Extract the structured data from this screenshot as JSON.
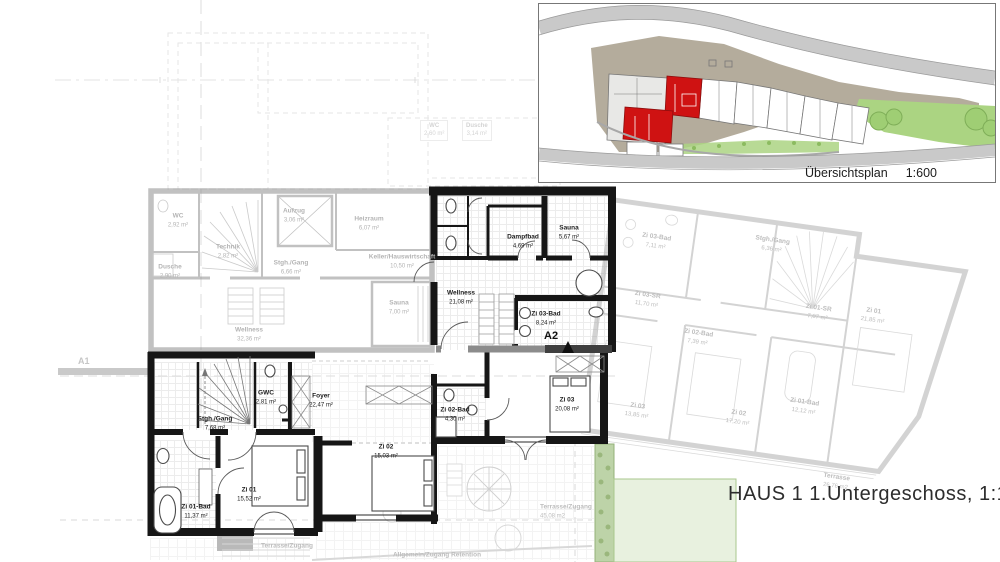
{
  "title": {
    "text": "HAUS 1 1.Untergeschoss, 1:100"
  },
  "overview": {
    "label": "Übersichtsplan",
    "scale": "1:600"
  },
  "section_markers": {
    "a1": "A1",
    "a2": "A2"
  },
  "palette": {
    "highlight_red": "#cf1212",
    "site_taupe": "#b4ac9c",
    "garden_green": "#abd482",
    "pale_green": "#e8f1df",
    "road_gray": "#c9c9c9",
    "wall_black": "#161616"
  },
  "main_plan": {
    "rooms": [
      {
        "name": "Dampfbad",
        "area": "4,69 m²"
      },
      {
        "name": "Sauna",
        "area": "5,67 m²"
      },
      {
        "name": "Wellness",
        "area": "21,08 m²"
      },
      {
        "name": "Zi 03-Bad",
        "area": "8,24 m²"
      },
      {
        "name": "Zi 03",
        "area": "20,08 m²"
      },
      {
        "name": "Foyer",
        "area": "22,47 m²"
      },
      {
        "name": "GWC",
        "area": "2,81 m²"
      },
      {
        "name": "Stgh./Gang",
        "area": "7,68 m²"
      },
      {
        "name": "Zi 02",
        "area": "15,03 m²"
      },
      {
        "name": "Zi 02-Bad",
        "area": "4,30 m²"
      },
      {
        "name": "Zi 01",
        "area": "15,52 m²"
      },
      {
        "name": "Zi 01-Bad",
        "area": "11,37 m²"
      }
    ]
  },
  "left_plan": {
    "rooms": [
      {
        "name": "WC",
        "area": "2,92 m²"
      },
      {
        "name": "Aufzug",
        "area": "3,06 m²"
      },
      {
        "name": "Heizraum",
        "area": "6,07 m²"
      },
      {
        "name": "Technik",
        "area": "2,82 m²"
      },
      {
        "name": "Stgh./Gang",
        "area": "6,66 m²"
      },
      {
        "name": "Keller/Hauswirtschaft",
        "area": "10,50 m²"
      },
      {
        "name": "Dusche",
        "area": "2,90 m²"
      },
      {
        "name": "Wellness",
        "area": "32,36 m²"
      },
      {
        "name": "Sauna",
        "area": "7,00 m²"
      }
    ]
  },
  "right_plan": {
    "rooms": [
      {
        "name": "Zi 03-Bad",
        "area": "7,11 m²"
      },
      {
        "name": "Stgh./Gang",
        "area": "6,36 m²"
      },
      {
        "name": "Zi 03-SR",
        "area": "11,70 m²"
      },
      {
        "name": "Zi 02-Bad",
        "area": "7,39 m²"
      },
      {
        "name": "Zi 01-SR",
        "area": "7,07 m²"
      },
      {
        "name": "Zi 03",
        "area": "13,85 m²"
      },
      {
        "name": "Zi 02",
        "area": "17,20 m²"
      },
      {
        "name": "Zi 01-Bad",
        "area": "12,12 m²"
      },
      {
        "name": "Zi 01",
        "area": "21,85 m²"
      },
      {
        "name": "Terrasse",
        "area": "26,76 m2"
      }
    ]
  },
  "upper_floor_ghost": {
    "rooms": [
      {
        "name": "WC",
        "area": "2,60 m²"
      },
      {
        "name": "Dusche",
        "area": "3,14 m²"
      }
    ]
  },
  "outdoor": {
    "labels": [
      {
        "name": "Terrasse/Zugang",
        "area": ""
      },
      {
        "name": "Terrasse/Zugang",
        "area": "45,08 m2"
      },
      {
        "name": "Allgemein/Zugang Retention",
        "area": ""
      }
    ]
  }
}
